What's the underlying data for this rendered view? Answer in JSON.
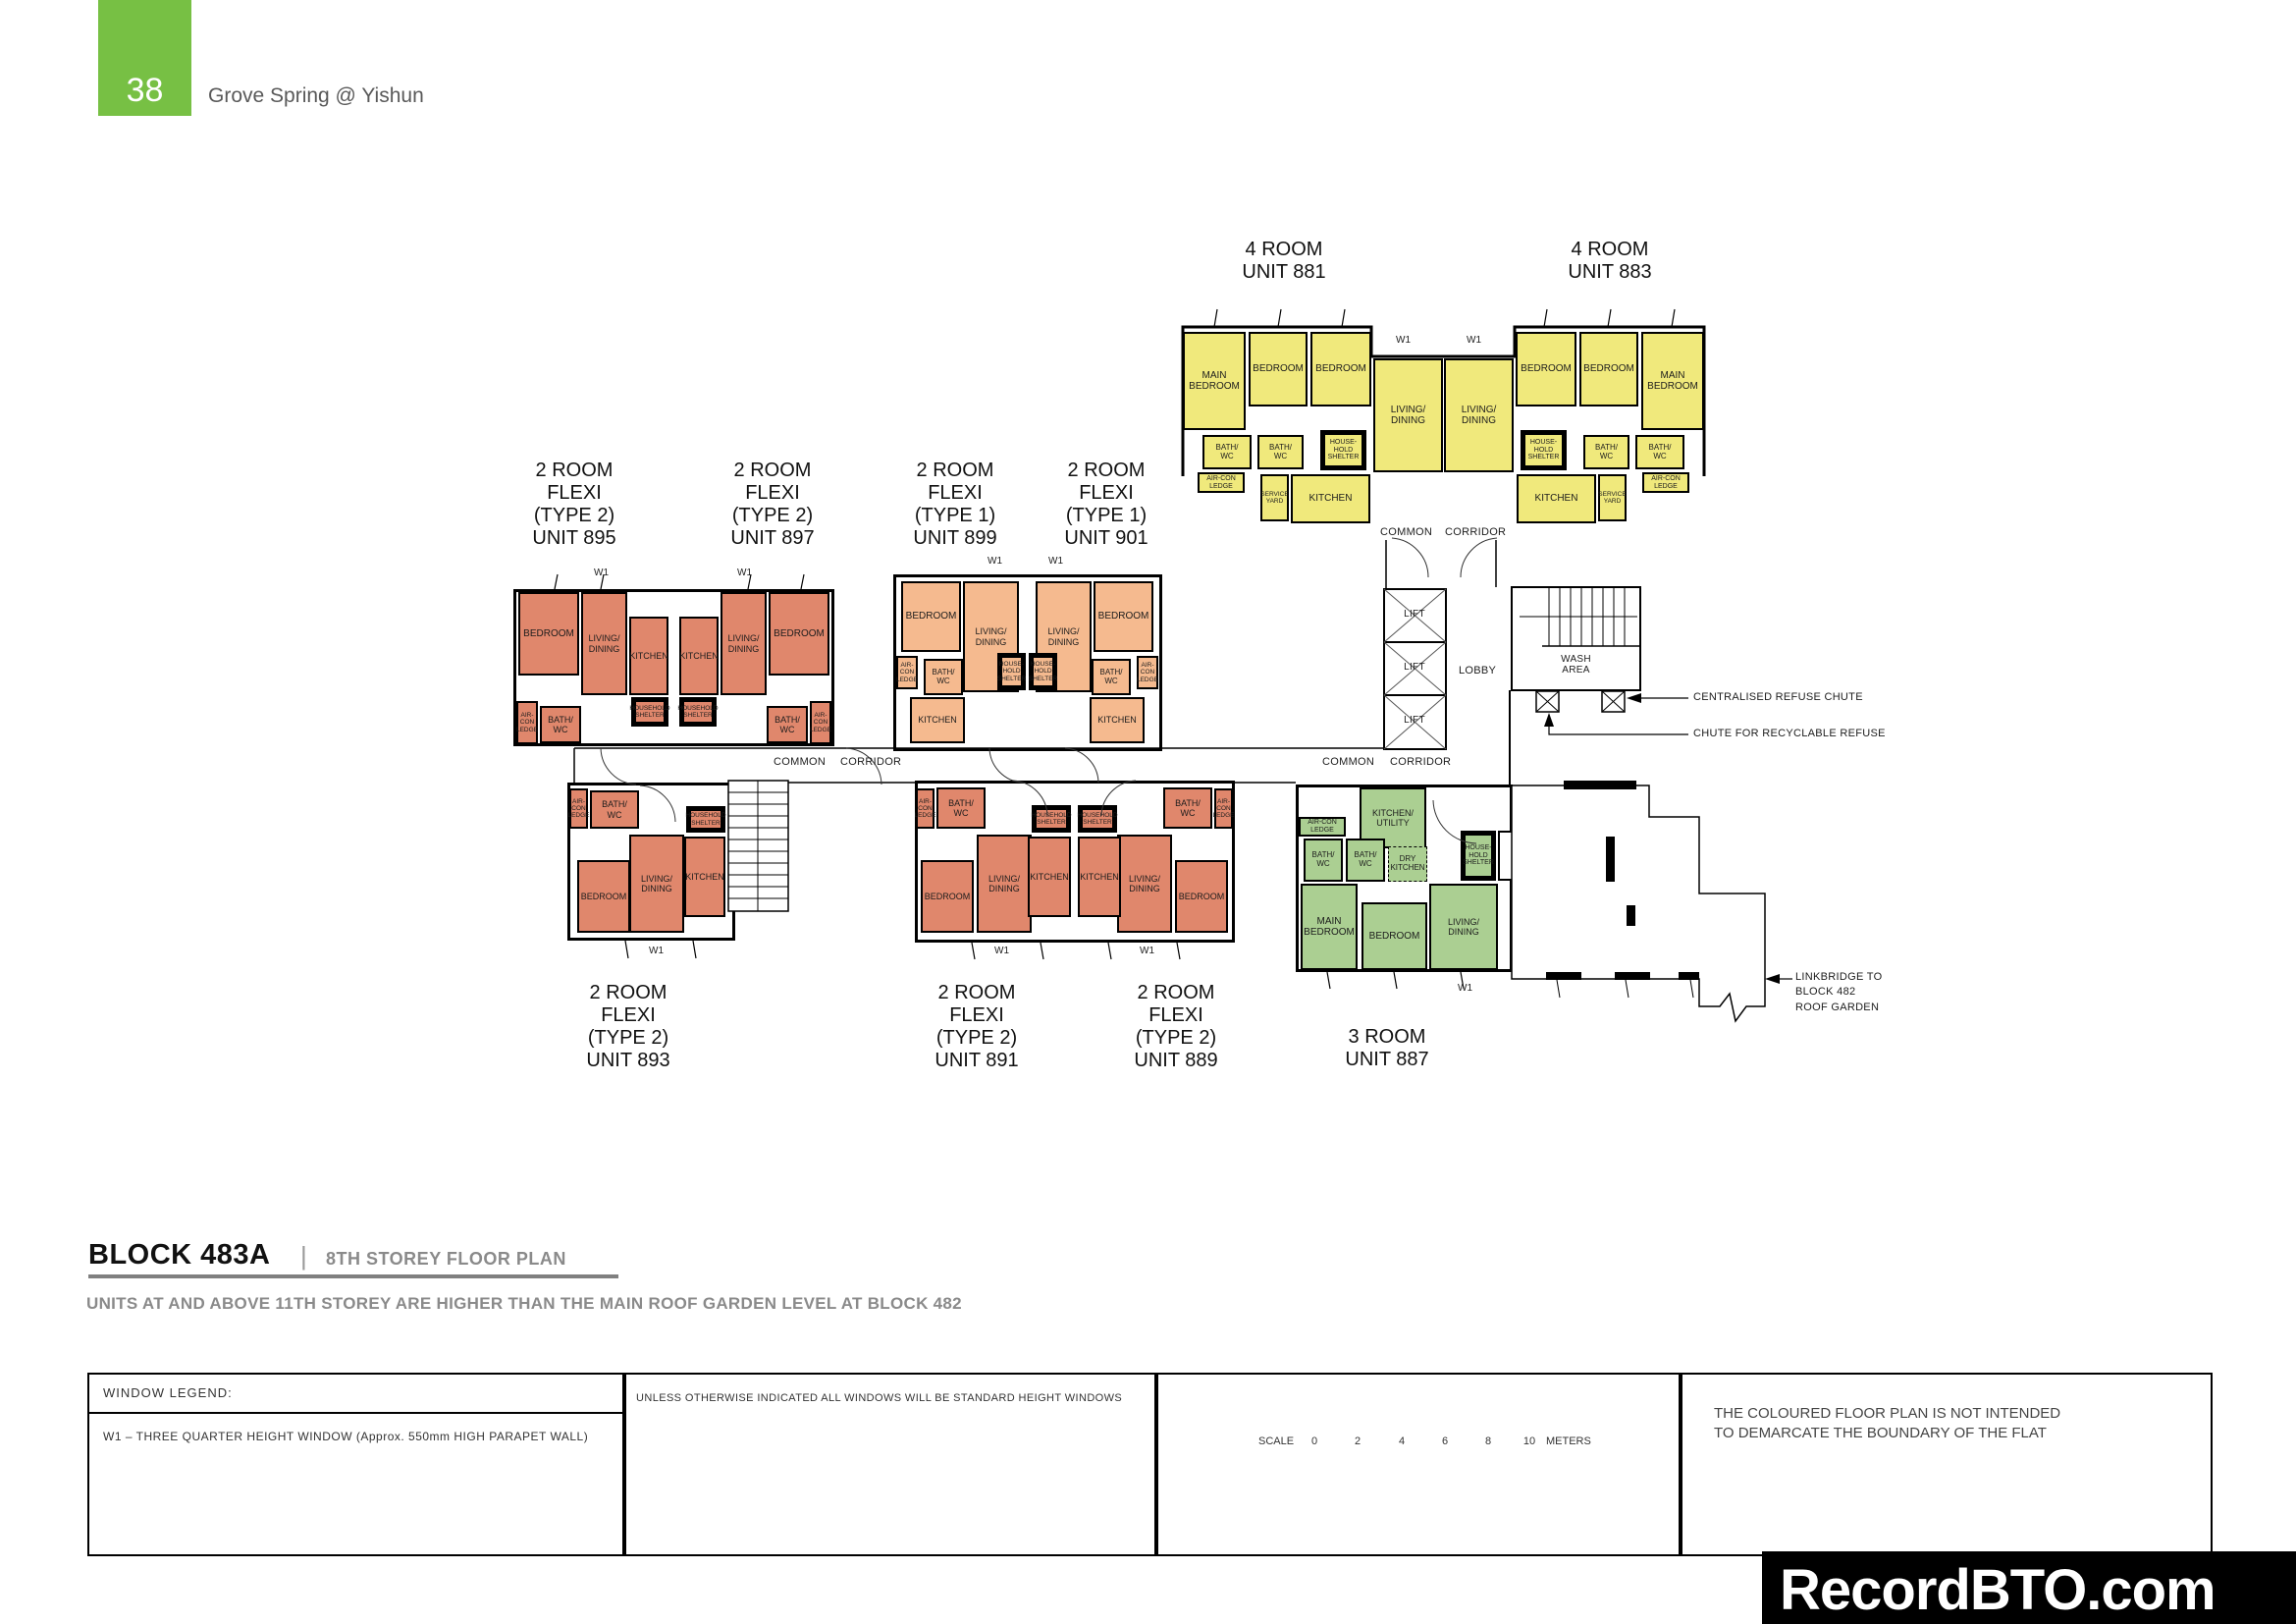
{
  "header": {
    "page_number": "38",
    "project_title": "Grove Spring @ Yishun"
  },
  "plan": {
    "w1": "W1",
    "common": "COMMON",
    "corridor": "CORRIDOR",
    "lift": "LIFT",
    "lobby": "LOBBY",
    "wash_area": "WASH\nAREA",
    "centralised_refuse": "CENTRALISED REFUSE CHUTE",
    "recyclable_refuse": "CHUTE FOR RECYCLABLE REFUSE",
    "linkbridge": "LINKBRIDGE TO\nBLOCK 482\nROOF GARDEN"
  },
  "units": {
    "u881": {
      "type_label": "4 ROOM\nUNIT 881",
      "rooms": {
        "main_bedroom": "MAIN\nBEDROOM",
        "bedroom_1": "BEDROOM",
        "bedroom_2": "BEDROOM",
        "living_dining": "LIVING/\nDINING",
        "bath_1": "BATH/\nWC",
        "bath_2": "BATH/\nWC",
        "household_shelter": "HOUSE-\nHOLD\nSHELTER",
        "aircon_ledge": "AIR-CON\nLEDGE",
        "service_yard": "SERVICE\nYARD",
        "kitchen": "KITCHEN"
      }
    },
    "u883": {
      "type_label": "4 ROOM\nUNIT 883",
      "rooms": {
        "main_bedroom": "MAIN\nBEDROOM",
        "bedroom_1": "BEDROOM",
        "bedroom_2": "BEDROOM",
        "living_dining": "LIVING/\nDINING",
        "bath_1": "BATH/\nWC",
        "bath_2": "BATH/\nWC",
        "household_shelter": "HOUSE-\nHOLD\nSHELTER",
        "aircon_ledge": "AIR-CON\nLEDGE",
        "service_yard": "SERVICE\nYARD",
        "kitchen": "KITCHEN"
      }
    },
    "u895": {
      "type_label": "2 ROOM\nFLEXI\n(TYPE 2)\nUNIT 895",
      "rooms": {
        "bedroom": "BEDROOM",
        "living_dining": "LIVING/\nDINING",
        "kitchen": "KITCHEN",
        "household_shelter": "HOUSEHOLD\nSHELTER",
        "bath": "BATH/\nWC",
        "aircon_ledge": "AIR-\nCON\nLEDGE"
      }
    },
    "u897": {
      "type_label": "2 ROOM\nFLEXI\n(TYPE 2)\nUNIT 897",
      "rooms": {
        "bedroom": "BEDROOM",
        "living_dining": "LIVING/\nDINING",
        "kitchen": "KITCHEN",
        "household_shelter": "HOUSEHOLD\nSHELTER",
        "bath": "BATH/\nWC",
        "aircon_ledge": "AIR-\nCON\nLEDGE"
      }
    },
    "u899": {
      "type_label": "2 ROOM\nFLEXI\n(TYPE 1)\nUNIT 899",
      "rooms": {
        "bedroom": "BEDROOM",
        "living_dining": "LIVING/\nDINING",
        "kitchen": "KITCHEN",
        "household_shelter": "HOUSE-\nHOLD\nSHELTER",
        "bath": "BATH/\nWC",
        "aircon_ledge": "AIR-\nCON\nLEDGE"
      }
    },
    "u901": {
      "type_label": "2 ROOM\nFLEXI\n(TYPE 1)\nUNIT 901",
      "rooms": {
        "bedroom": "BEDROOM",
        "living_dining": "LIVING/\nDINING",
        "kitchen": "KITCHEN",
        "household_shelter": "HOUSE-\nHOLD\nSHELTER",
        "bath": "BATH/\nWC",
        "aircon_ledge": "AIR-\nCON\nLEDGE"
      }
    },
    "u893": {
      "type_label": "2 ROOM\nFLEXI\n(TYPE 2)\nUNIT 893",
      "rooms": {
        "bedroom": "BEDROOM",
        "living_dining": "LIVING/\nDINING",
        "kitchen": "KITCHEN",
        "household_shelter": "HOUSEHOLD\nSHELTER",
        "bath": "BATH/\nWC",
        "aircon_ledge": "AIR-\nCON\nLEDGE"
      }
    },
    "u891": {
      "type_label": "2 ROOM\nFLEXI\n(TYPE 2)\nUNIT 891",
      "rooms": {
        "bedroom": "BEDROOM",
        "living_dining": "LIVING/\nDINING",
        "kitchen": "KITCHEN",
        "household_shelter": "HOUSEHOLD\nSHELTER",
        "bath": "BATH/\nWC",
        "aircon_ledge": "AIR-\nCON\nLEDGE"
      }
    },
    "u889": {
      "type_label": "2 ROOM\nFLEXI\n(TYPE 2)\nUNIT 889",
      "rooms": {
        "bedroom": "BEDROOM",
        "living_dining": "LIVING/\nDINING",
        "kitchen": "KITCHEN",
        "household_shelter": "HOUSEHOLD\nSHELTER",
        "bath": "BATH/\nWC",
        "aircon_ledge": "AIR-\nCON\nLEDGE"
      }
    },
    "u887": {
      "type_label": "3 ROOM\nUNIT 887",
      "rooms": {
        "aircon_ledge": "AIR-CON\nLEDGE",
        "kitchen_utility": "KITCHEN/\nUTILITY",
        "bath_1": "BATH/\nWC",
        "bath_2": "BATH/\nWC",
        "dry_kitchen": "DRY\nKITCHEN",
        "household_shelter": "HOUSE-\nHOLD\nSHELTER",
        "main_bedroom": "MAIN\nBEDROOM",
        "bedroom": "BEDROOM",
        "living_dining": "LIVING/\nDINING"
      }
    }
  },
  "footer": {
    "block_title": "BLOCK 483A",
    "separator": "|",
    "plan_title": "8TH STOREY FLOOR PLAN",
    "note": "UNITS AT AND ABOVE 11TH STOREY ARE HIGHER THAN THE MAIN ROOF GARDEN LEVEL AT BLOCK 482"
  },
  "legend": {
    "window_legend_title": "WINDOW LEGEND:",
    "w1_description": "W1 – THREE QUARTER HEIGHT WINDOW (Approx. 550mm HIGH PARAPET WALL)",
    "windows_note": "UNLESS OTHERWISE INDICATED ALL WINDOWS WILL BE STANDARD HEIGHT WINDOWS",
    "scale_label": "SCALE",
    "scale_ticks": [
      "0",
      "2",
      "4",
      "6",
      "8",
      "10"
    ],
    "scale_unit": "METERS",
    "boundary_note": "THE COLOURED FLOOR PLAN IS NOT INTENDED\nTO DEMARCATE THE BOUNDARY OF THE FLAT"
  },
  "watermark": {
    "site": "RecordBTO.com"
  },
  "colors": {
    "four_room": "#F0E97C",
    "two_room_type2": "#E0876C",
    "two_room_type1": "#F5BA8F",
    "three_room": "#ABCF92",
    "header_green": "#77C044"
  }
}
